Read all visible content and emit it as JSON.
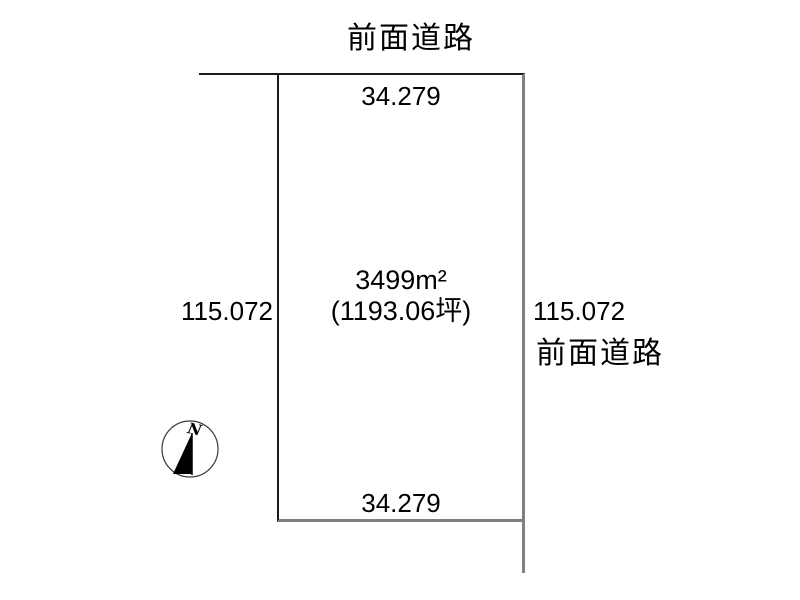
{
  "diagram": {
    "type": "land-plot-diagram",
    "top_road_label": "前面道路",
    "right_road_label": "前面道路",
    "parcel": {
      "area_m2": "3499m²",
      "area_tsubo": "(1193.06坪)",
      "top_dim": "34.279",
      "bottom_dim": "34.279",
      "left_dim": "115.072",
      "right_dim": "115.072"
    },
    "compass": {
      "label": "N"
    },
    "colors": {
      "background": "#ffffff",
      "line_dark": "#1a1a1a",
      "line_gray": "#808080",
      "text": "#000000"
    }
  }
}
